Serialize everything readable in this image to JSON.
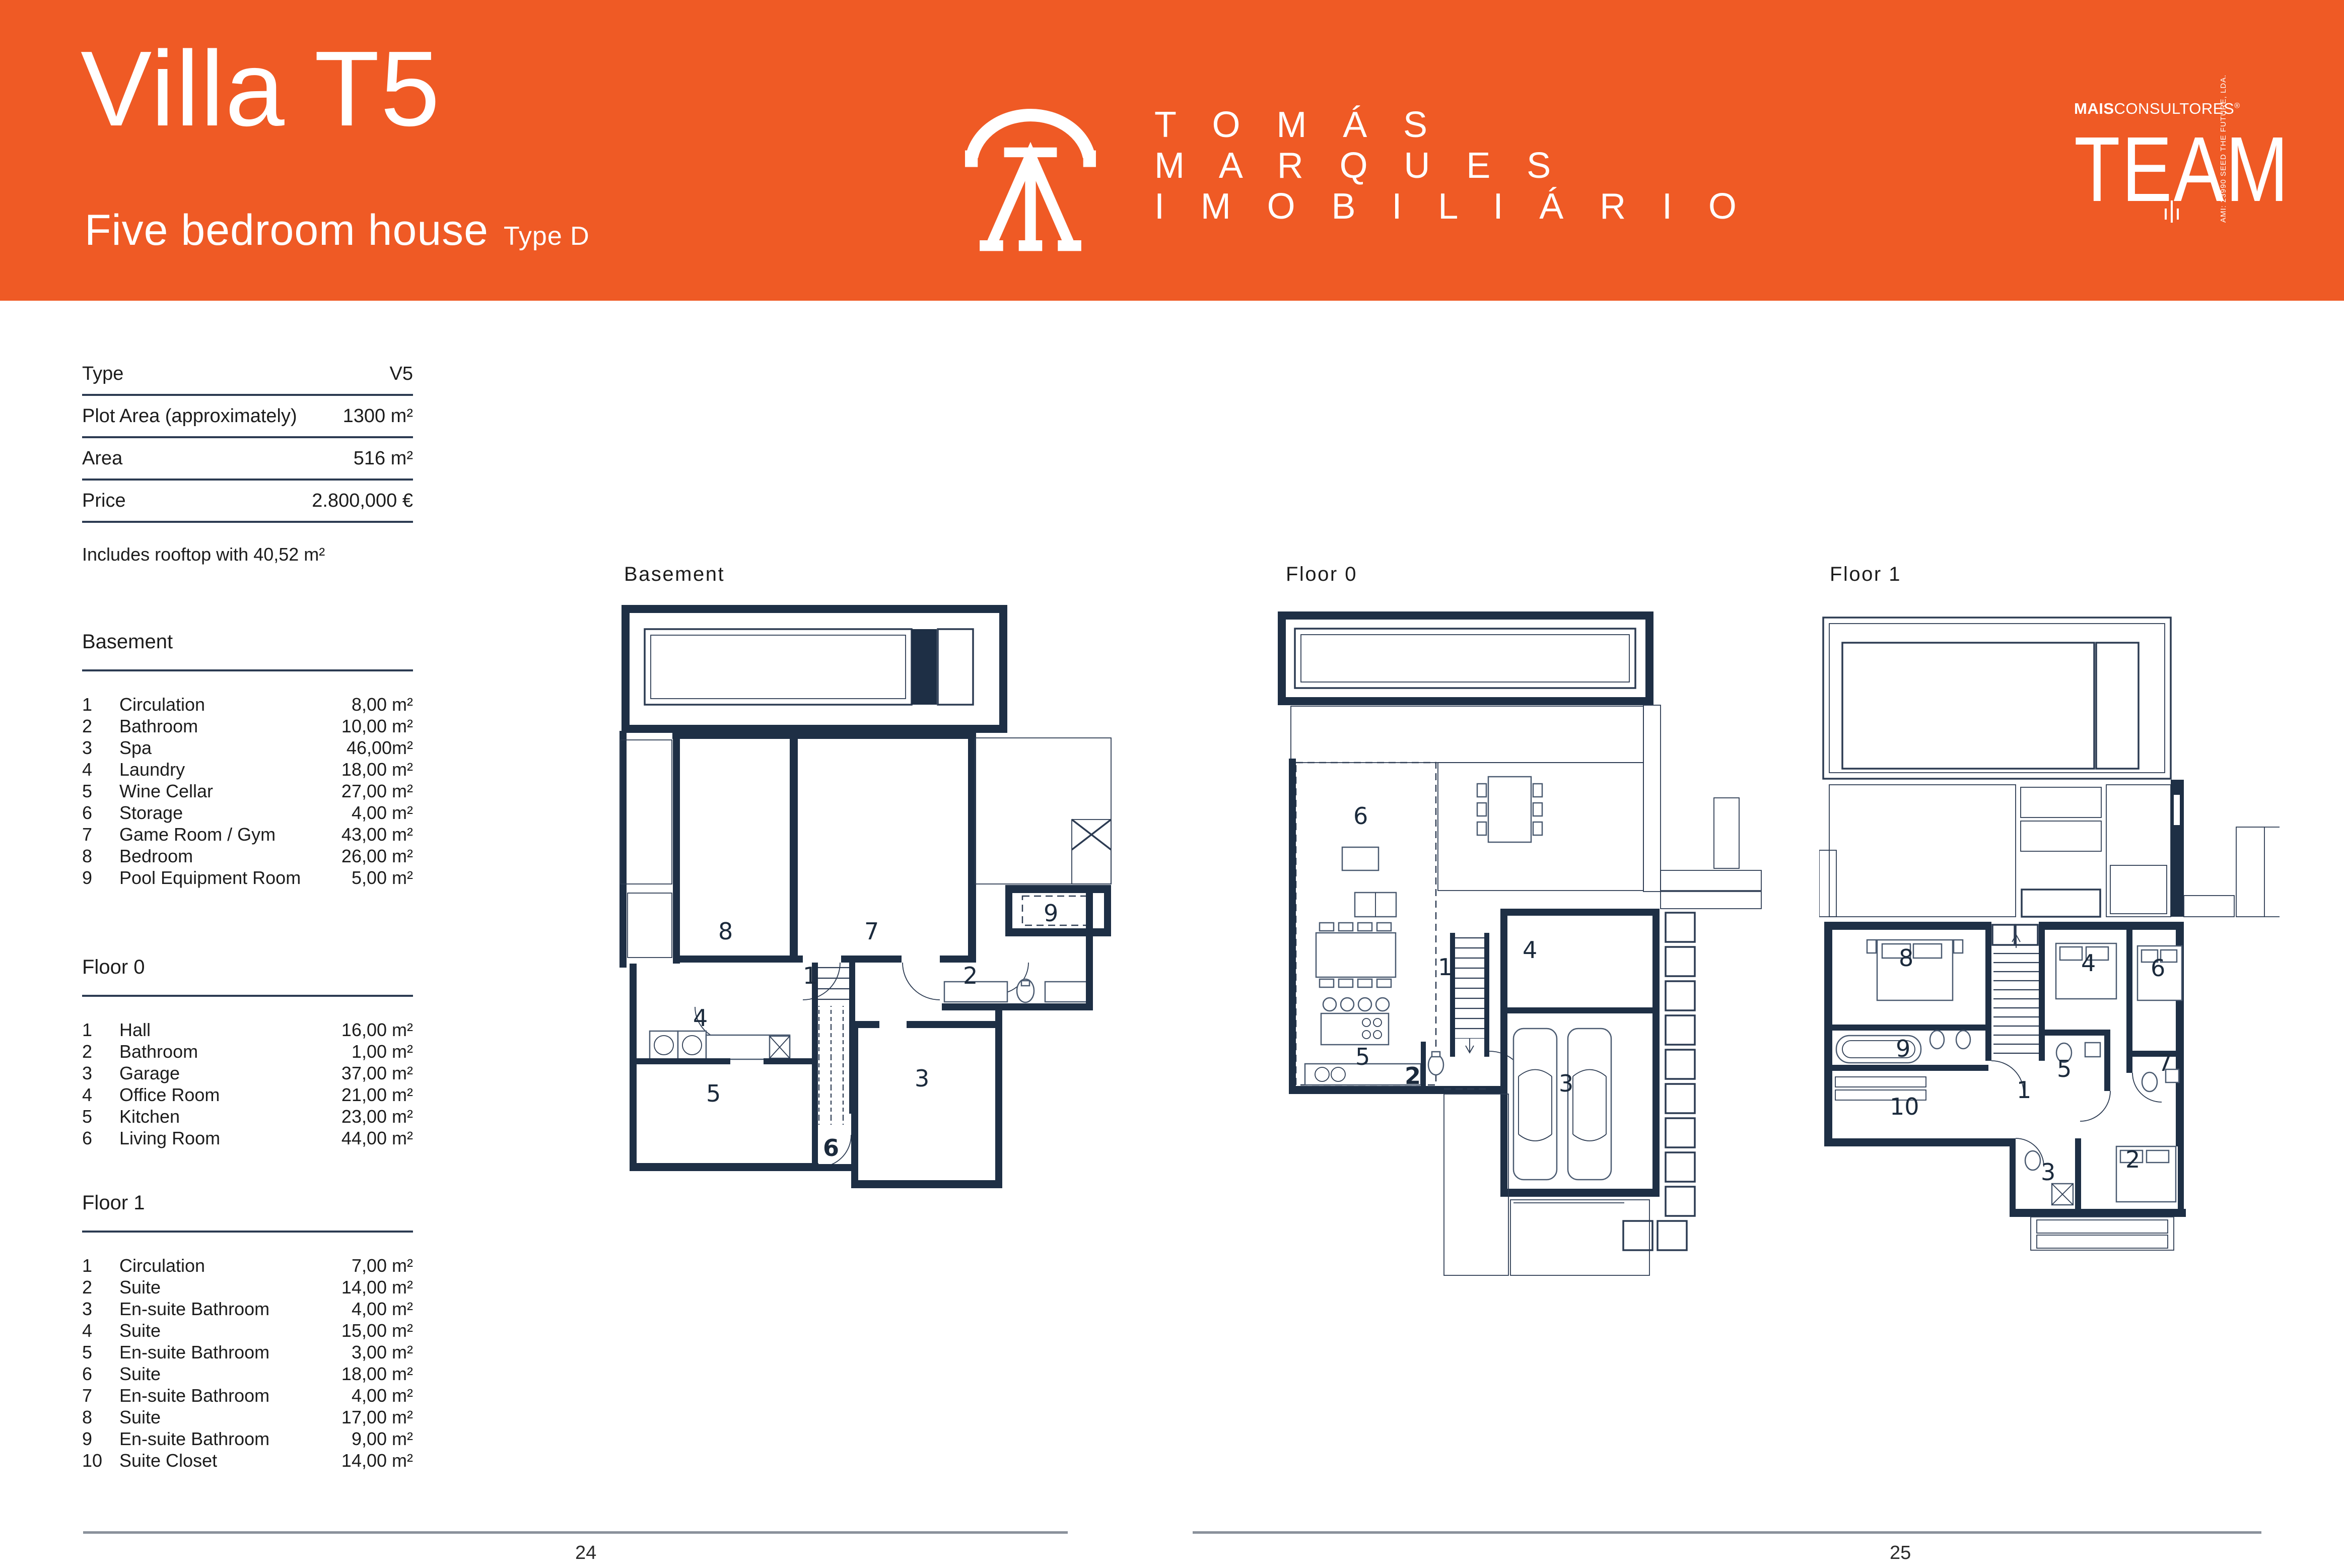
{
  "colors": {
    "orange": "#EF5A25",
    "navy": "#1E2F45",
    "table_line": "#2C3B52",
    "footer_line": "#8A919B"
  },
  "header": {
    "title": "Villa T5",
    "subtitle": "Five bedroom house",
    "type_label": "Type D",
    "brand": {
      "line1": "T O M Á S",
      "line2": "M A R Q U E S",
      "line3": "I M O B I L I Á R I O"
    },
    "consultores": {
      "bold": "MAIS",
      "light": "CONSULTORES",
      "registered": "®",
      "team": "TEAM",
      "side": "AMI: 23990  SEED THE FUTURE, LDA."
    }
  },
  "specs": {
    "rows": [
      {
        "label": "Type",
        "value": "V5"
      },
      {
        "label": "Plot Area (approximately)",
        "value": "1300 m²"
      },
      {
        "label": "Area",
        "value": "516 m²"
      },
      {
        "label": "Price",
        "value": "2.800,000 €"
      }
    ],
    "note": "Includes rooftop with 40,52 m²"
  },
  "sections": [
    {
      "title": "Basement",
      "rows": [
        {
          "num": "1",
          "name": "Circulation",
          "area": "8,00 m²"
        },
        {
          "num": "2",
          "name": "Bathroom",
          "area": "10,00 m²"
        },
        {
          "num": "3",
          "name": "Spa",
          "area": "46,00m²"
        },
        {
          "num": "4",
          "name": "Laundry",
          "area": "18,00 m²"
        },
        {
          "num": "5",
          "name": "Wine Cellar",
          "area": "27,00 m²"
        },
        {
          "num": "6",
          "name": "Storage",
          "area": "4,00 m²"
        },
        {
          "num": "7",
          "name": "Game Room / Gym",
          "area": "43,00 m²"
        },
        {
          "num": "8",
          "name": "Bedroom",
          "area": "26,00 m²"
        },
        {
          "num": "9",
          "name": "Pool Equipment Room",
          "area": "5,00 m²"
        }
      ]
    },
    {
      "title": "Floor 0",
      "rows": [
        {
          "num": "1",
          "name": "Hall",
          "area": "16,00 m²"
        },
        {
          "num": "2",
          "name": "Bathroom",
          "area": "1,00 m²"
        },
        {
          "num": "3",
          "name": "Garage",
          "area": "37,00 m²"
        },
        {
          "num": "4",
          "name": "Office Room",
          "area": "21,00 m²"
        },
        {
          "num": "5",
          "name": "Kitchen",
          "area": "23,00 m²"
        },
        {
          "num": "6",
          "name": "Living Room",
          "area": "44,00 m²"
        }
      ]
    },
    {
      "title": "Floor 1",
      "rows": [
        {
          "num": "1",
          "name": "Circulation",
          "area": "7,00 m²"
        },
        {
          "num": "2",
          "name": "Suite",
          "area": "14,00 m²"
        },
        {
          "num": "3",
          "name": "En-suite Bathroom",
          "area": "4,00 m²"
        },
        {
          "num": "4",
          "name": "Suite",
          "area": "15,00 m²"
        },
        {
          "num": "5",
          "name": "En-suite Bathroom",
          "area": "3,00 m²"
        },
        {
          "num": "6",
          "name": "Suite",
          "area": "18,00 m²"
        },
        {
          "num": "7",
          "name": "En-suite Bathroom",
          "area": "4,00 m²"
        },
        {
          "num": "8",
          "name": "Suite",
          "area": "17,00 m²"
        },
        {
          "num": "9",
          "name": "En-suite Bathroom",
          "area": "9,00 m²"
        },
        {
          "num": "10",
          "name": "Suite Closet",
          "area": "14,00 m²"
        }
      ]
    }
  ],
  "plans": [
    {
      "label": "Basement",
      "rooms": [
        {
          "n": "8"
        },
        {
          "n": "7"
        },
        {
          "n": "9"
        },
        {
          "n": "1"
        },
        {
          "n": "2"
        },
        {
          "n": "4"
        },
        {
          "n": "5"
        },
        {
          "n": "6"
        },
        {
          "n": "3"
        }
      ]
    },
    {
      "label": "Floor 0",
      "rooms": [
        {
          "n": "6"
        },
        {
          "n": "5"
        },
        {
          "n": "2"
        },
        {
          "n": "1"
        },
        {
          "n": "4"
        },
        {
          "n": "3"
        }
      ]
    },
    {
      "label": "Floor 1",
      "rooms": [
        {
          "n": "8"
        },
        {
          "n": "9"
        },
        {
          "n": "10"
        },
        {
          "n": "1"
        },
        {
          "n": "4"
        },
        {
          "n": "5"
        },
        {
          "n": "6"
        },
        {
          "n": "7"
        },
        {
          "n": "2"
        },
        {
          "n": "3"
        }
      ]
    }
  ],
  "footer": {
    "left_page": "24",
    "right_page": "25"
  }
}
